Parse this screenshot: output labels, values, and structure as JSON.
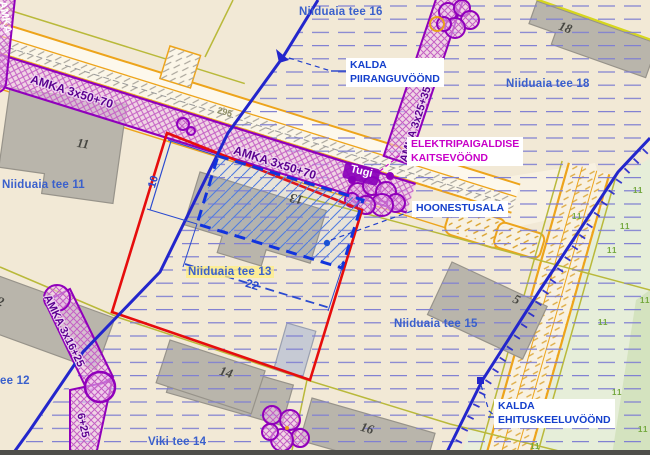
{
  "basemap": {
    "street_labels": {
      "tee16": "Niiduaia tee 16",
      "tee18": "Niiduaia tee 18",
      "tee11": "Niiduaia tee 11",
      "tee13": "Niiduaia tee 13",
      "tee15": "Niiduaia tee 15",
      "tee12_partial": "ee 12",
      "viki14": "Viki tee 14"
    },
    "building_numbers": {
      "b11": "11",
      "b13": "13",
      "b18": "18",
      "b12": "12",
      "b14": "14",
      "b16": "16",
      "b5": "5"
    },
    "road_point_label": "295",
    "vegetation_glyph": "11"
  },
  "utilities": {
    "cable_labels": {
      "road1": "AMKA 3x50+70",
      "road2": "AMKA 3x50+70",
      "northeast": "AMKA 3x25+35",
      "southwest": "AMKA 3x16+25",
      "southwest_partial": "6+25",
      "left_edge": "AMKA"
    },
    "pole_label": "Tugi"
  },
  "zones": {
    "kalda_piiranguvoond": {
      "line1": "KALDA",
      "line2": "PIIRANGUVÖÖND"
    },
    "elektripaigaldise_kaitsevoond": {
      "line1": "ELEKTRIPAIGALDISE",
      "line2": "KAITSEVÖÖND"
    },
    "hoonestusala": {
      "label": "HOONESTUSALA"
    },
    "kalda_ehituskeeluvoond": {
      "line1": "KALDA",
      "line2": "EHITUSKEELUVÖÖND"
    }
  },
  "dimensions": {
    "building_area_width": "22",
    "building_area_depth": "10"
  },
  "colors": {
    "zone_label_blue": "#1540cc",
    "utility_magenta": "#c800c8",
    "street_label_blue": "#3a60cc",
    "boundary_red": "#e60d0d",
    "cable_purple": "#9000bb",
    "parcel_orange": "#eda41b",
    "parcel_olive": "#b9b93a",
    "restriction_zone_blue": "#2326cc",
    "background_beige": "#f2e9d6",
    "greenery": "#e6eed9"
  }
}
